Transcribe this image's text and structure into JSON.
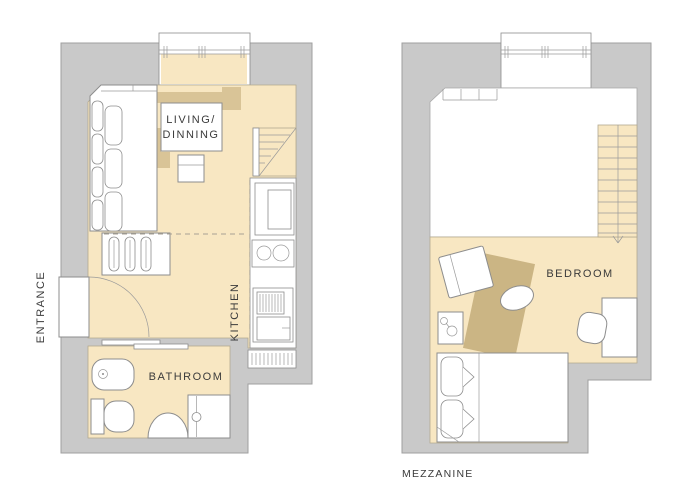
{
  "ground_floor": {
    "entrance": "ENTRANCE",
    "living_line1": "LIVING/",
    "living_line2": "DINNING",
    "kitchen": "KITCHEN",
    "bathroom": "BATHROOM"
  },
  "mezzanine_floor": {
    "bedroom": "BEDROOM",
    "title": "MEZZANINE"
  },
  "colors": {
    "wall": "#c9c9c9",
    "wall_outline": "#9f9f9f",
    "floor": "#f8e7c2",
    "accent": "#d9c497",
    "rug": "#cbb584",
    "furniture_line": "#8d8d8d",
    "dash": "#a9a294",
    "text": "#3b3b3b",
    "white": "#ffffff"
  }
}
